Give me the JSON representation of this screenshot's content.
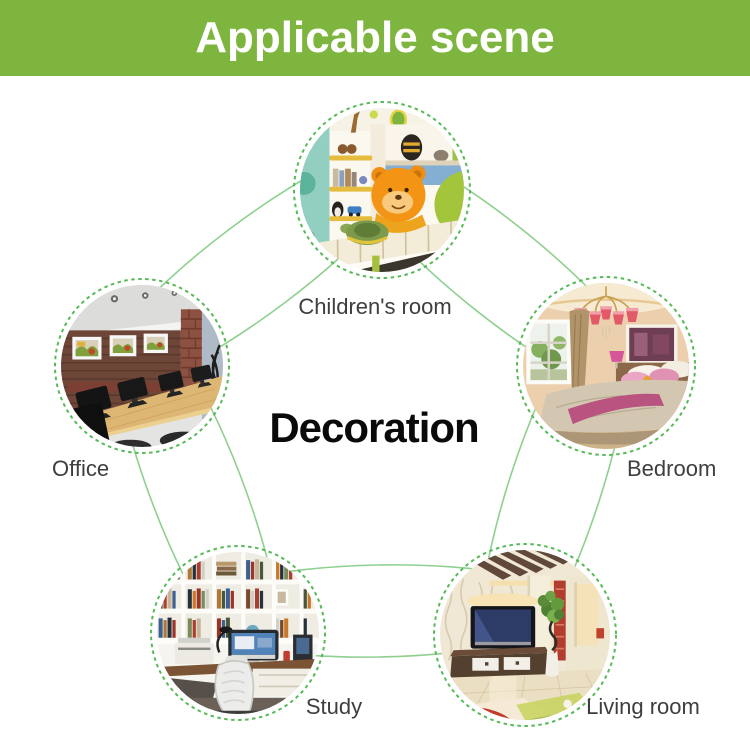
{
  "header": {
    "title": "Applicable scene"
  },
  "center_label": "Decoration",
  "scenes": [
    {
      "id": "children-room",
      "label": "Children's room",
      "image_alt": "Children's room photo: corner shelf with toys, bed with orange plush bear"
    },
    {
      "id": "bedroom",
      "label": "Bedroom",
      "image_alt": "Bedroom photo: pink chandelier, window, double bed with pink pillows"
    },
    {
      "id": "living-room",
      "label": "Living room",
      "image_alt": "Living room photo: wall TV over wooden cabinet, plant, patterned rug"
    },
    {
      "id": "study",
      "label": "Study",
      "image_alt": "Study photo: white bookshelves full of books, desk computer, office chair"
    },
    {
      "id": "office",
      "label": "Office",
      "image_alt": "Office photo: wood wall with three framed pictures, long desk with monitors"
    }
  ],
  "colors": {
    "pageBg": "#ffffff",
    "headerGreen": "#7db53e",
    "headerText": "#ffffff",
    "connectorGreen": "#8fd08f",
    "ringGreen": "#57b957",
    "labelGray": "#3e3e3e",
    "centerText": "#0a0a0a"
  }
}
